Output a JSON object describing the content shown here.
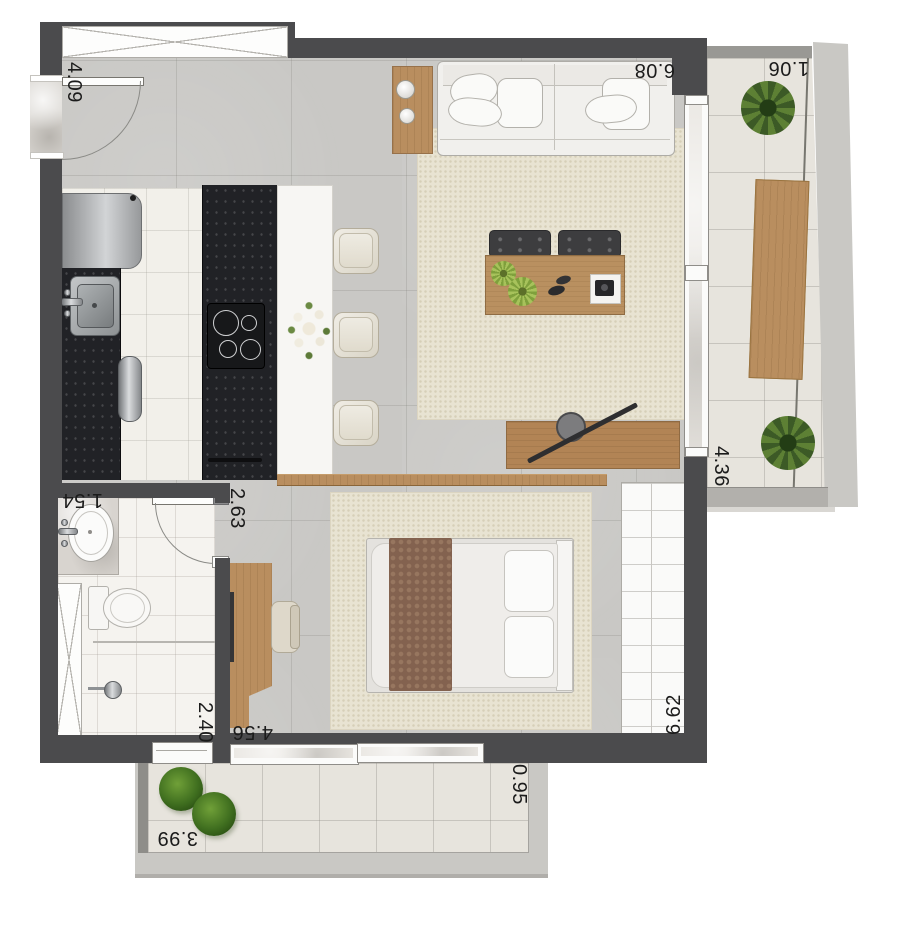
{
  "plan": {
    "dimensions": {
      "entry_side": "4.09",
      "living_top": "6.08",
      "balcony_right_width": "1.06",
      "balcony_right_length": "4.36",
      "bedroom_top": "2.63",
      "bathroom_width": "1.54",
      "bathroom_length": "2.40",
      "bedroom_bottom": "4.56",
      "interior_right_length": "6.62",
      "balcony_bottom_length": "3.99",
      "balcony_bottom_depth": "0.95"
    },
    "colors": {
      "wall": "#4b4b4d",
      "concrete_floor": "#c9c8c5",
      "kitchen_tile": "#f2f0ea",
      "dark_counter": "#212226",
      "wood": "#b98e5f",
      "rug": "#e8e3d2",
      "balcony_floor": "#e7e4dd",
      "label_text": "#1b1b1b"
    }
  }
}
